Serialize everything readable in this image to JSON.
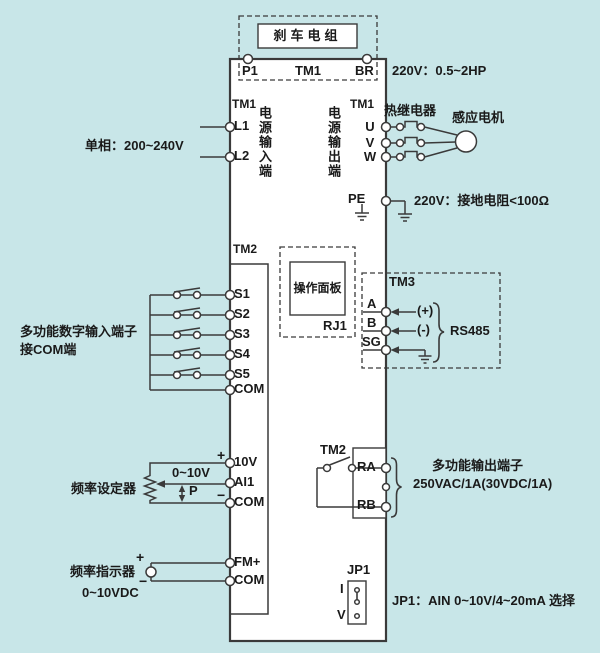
{
  "colors": {
    "background": "#c8e6e8",
    "line": "#3a3a3a",
    "box_fill": "#ffffff",
    "text": "#1a1a1a"
  },
  "brake": {
    "label": "刹车电组",
    "p1": "P1",
    "tm1": "TM1",
    "br": "BR",
    "rating": "220V：0.5~2HP"
  },
  "power_input": {
    "tm1": "TM1",
    "l1": "L1",
    "l2": "L2",
    "vertical_label": "电源输入端",
    "phase_note": "单相：200~240V"
  },
  "power_output": {
    "vertical_label": "电源输出端",
    "tm1": "TM1",
    "u": "U",
    "v": "V",
    "w": "W",
    "thermal_relay": "热继电器",
    "motor": "感应电机",
    "pe": "PE",
    "ground_note": "220V：接地电阻<100Ω"
  },
  "digital_inputs": {
    "tm2": "TM2",
    "terminals": [
      "S1",
      "S2",
      "S3",
      "S4",
      "S5",
      "COM"
    ],
    "note_line1": "多功能数字输入端子",
    "note_line2": "接COM端"
  },
  "panel": {
    "label": "操作面板",
    "rj1": "RJ1"
  },
  "rs485": {
    "tm3": "TM3",
    "a": "A",
    "b": "B",
    "sg": "SG",
    "plus": "(+)",
    "minus": "(-)",
    "label": "RS485"
  },
  "analog_input": {
    "plus": "+",
    "v10": "10V",
    "ai1": "AI1",
    "com": "COM",
    "minus": "−",
    "range": "0~10V",
    "p": "P",
    "setter": "频率设定器"
  },
  "relay_output": {
    "tm2": "TM2",
    "ra": "RA",
    "rb": "RB",
    "note_line1": "多功能输出端子",
    "note_line2": "250VAC/1A(30VDC/1A)"
  },
  "frequency_meter": {
    "plus": "+",
    "minus": "−",
    "fm": "FM+",
    "com": "COM",
    "label": "频率指示器",
    "range": "0~10VDC"
  },
  "jumper": {
    "jp1": "JP1",
    "i": "I",
    "v": "V",
    "note": "JP1：AIN 0~10V/4~20mA 选择"
  }
}
